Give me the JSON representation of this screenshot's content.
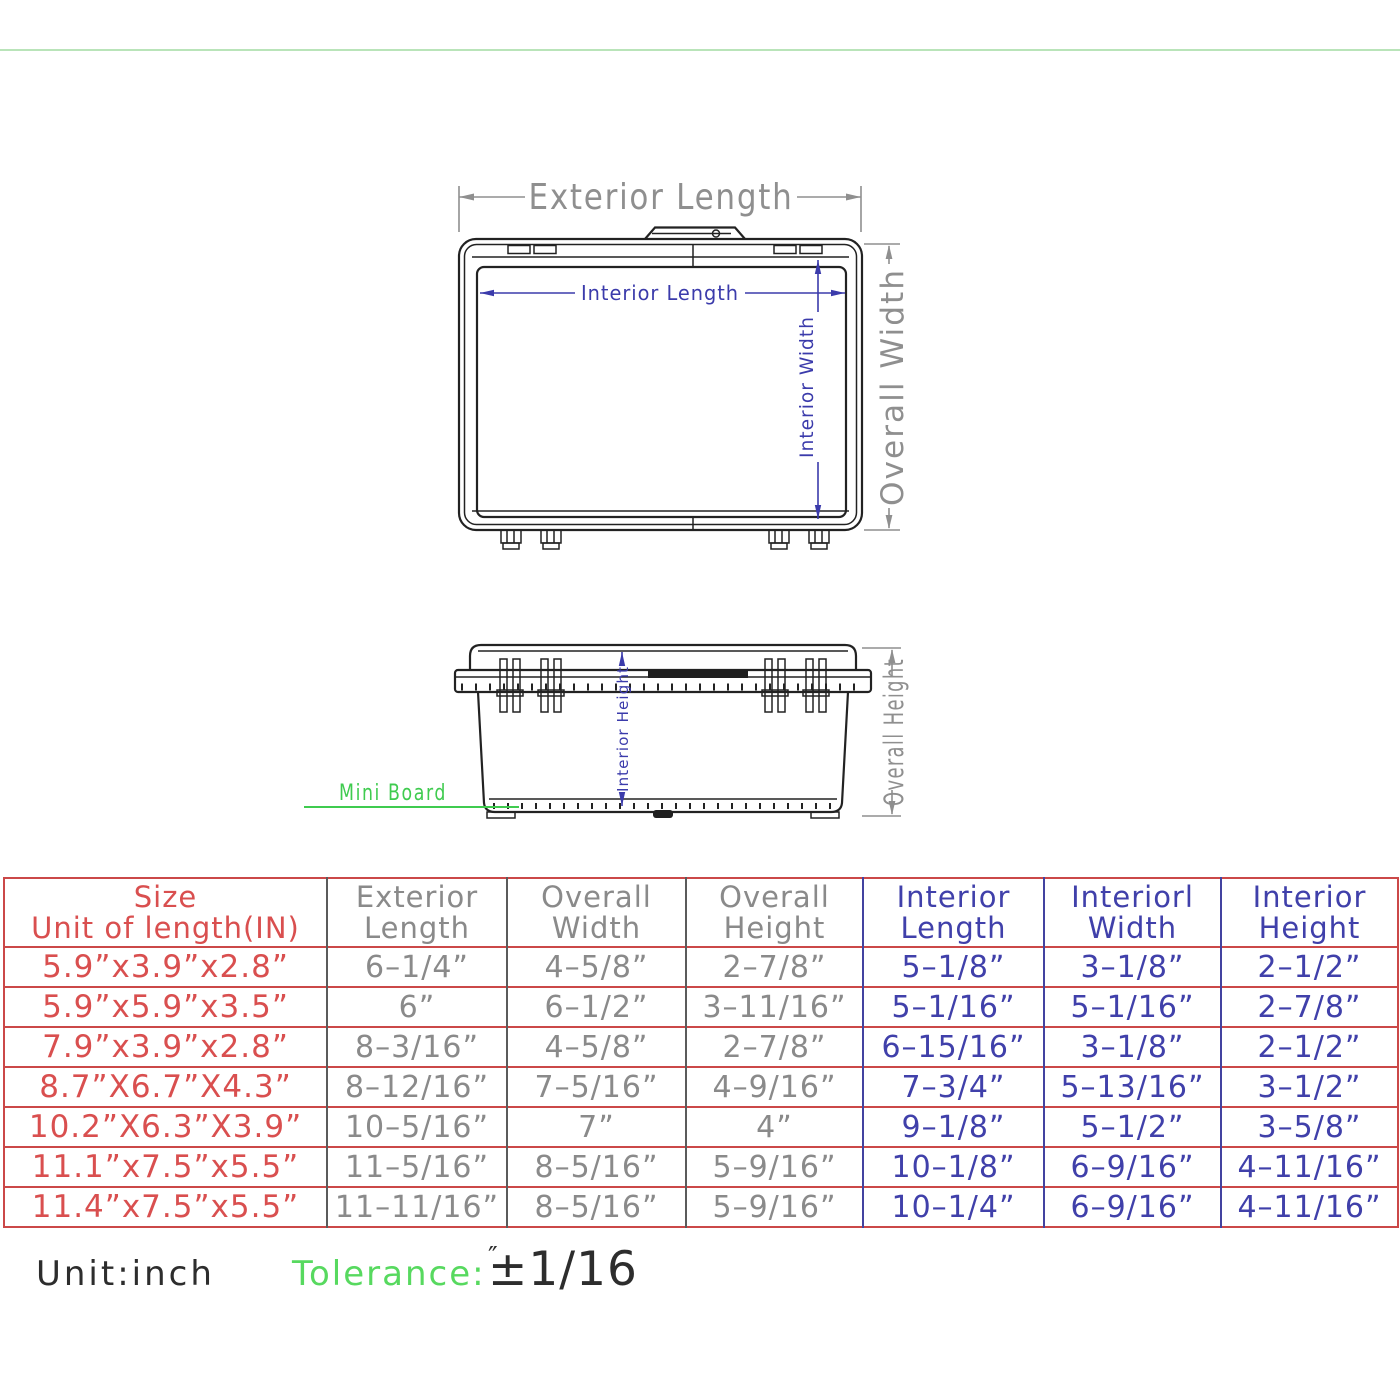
{
  "colors": {
    "table_border_red": "#cb4848",
    "size_text_red": "#d94f4f",
    "dim_gray": "#8f8f8f",
    "dim_blue": "#3b3bab",
    "green": "#3fcb4f",
    "divider_green": "#b9e4b9",
    "line_dark": "#222222"
  },
  "top_view": {
    "labels": {
      "exterior_length": "Exterior Length",
      "interior_length": "Interior Length",
      "interior_width": "Interior Width",
      "overall_width": "Overall Width"
    }
  },
  "side_view": {
    "labels": {
      "interior_height": "Interior Height",
      "overall_height": "Overall Height",
      "mini_board": "Mini Board"
    }
  },
  "table": {
    "header": [
      {
        "line1": "Size",
        "line2": "Unit of length(IN)"
      },
      {
        "line1": "Exterior",
        "line2": "Length"
      },
      {
        "line1": "Overall",
        "line2": "Width"
      },
      {
        "line1": "Overall",
        "line2": "Height"
      },
      {
        "line1": "Interior",
        "line2": "Length"
      },
      {
        "line1": "Interiorl",
        "line2": "Width"
      },
      {
        "line1": "Interior",
        "line2": "Height"
      }
    ],
    "rows": [
      [
        "5.9”x3.9”x2.8”",
        "6–1/4”",
        "4–5/8”",
        "2–7/8”",
        "5–1/8”",
        "3–1/8”",
        "2–1/2”"
      ],
      [
        "5.9”x5.9”x3.5”",
        "6”",
        "6–1/2”",
        "3–11/16”",
        "5–1/16”",
        "5–1/16”",
        "2–7/8”"
      ],
      [
        "7.9”x3.9”x2.8”",
        "8–3/16”",
        "4–5/8”",
        "2–7/8”",
        "6–15/16”",
        "3–1/8”",
        "2–1/2”"
      ],
      [
        "8.7”X6.7”X4.3”",
        "8–12/16”",
        "7–5/16”",
        "4–9/16”",
        "7–3/4”",
        "5–13/16”",
        "3–1/2”"
      ],
      [
        "10.2”X6.3”X3.9”",
        "10–5/16”",
        "7”",
        "4”",
        "9–1/8”",
        "5–1/2”",
        "3–5/8”"
      ],
      [
        "11.1”x7.5”x5.5”",
        "11–5/16”",
        "8–5/16”",
        "5–9/16”",
        "10–1/8”",
        "6–9/16”",
        "4–11/16”"
      ],
      [
        "11.4”x7.5”x5.5”",
        "11–11/16”",
        "8–5/16”",
        "5–9/16”",
        "10–1/4”",
        "6–9/16”",
        "4–11/16”"
      ]
    ]
  },
  "footer": {
    "unit_label": "Unit:inch",
    "tolerance_label": "Tolerance:",
    "tolerance_value": "±1/16",
    "tolerance_unit": "″"
  }
}
